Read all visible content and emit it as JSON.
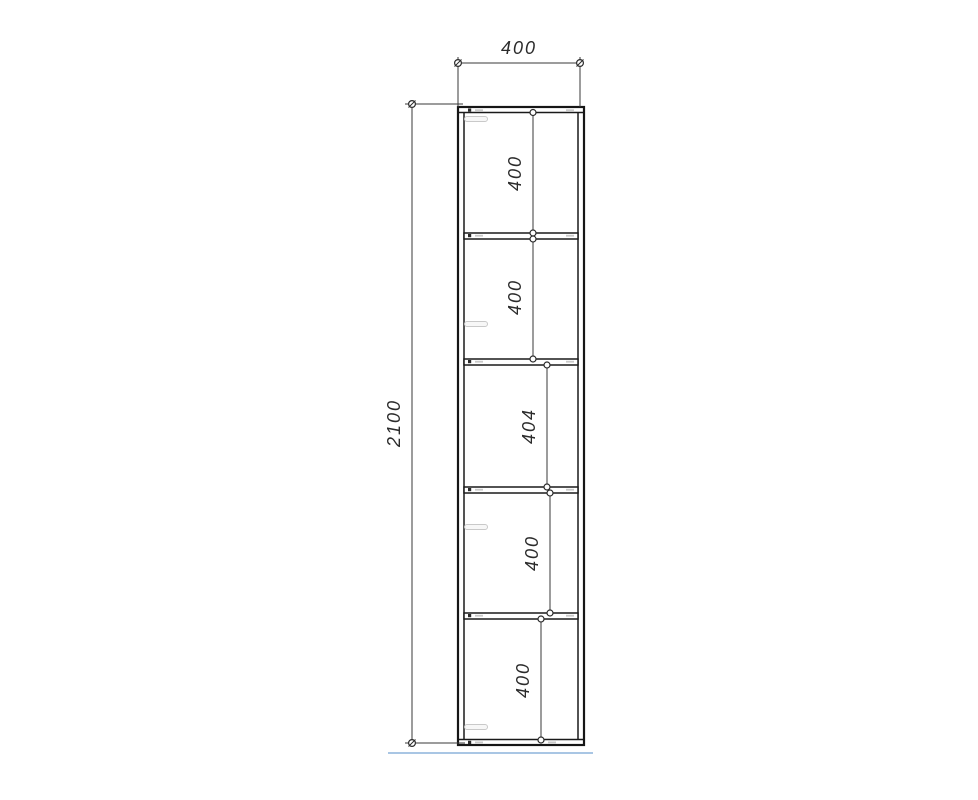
{
  "drawing": {
    "dimensions": {
      "width": "400",
      "height": "2100",
      "compartments": [
        "400",
        "400",
        "404",
        "400",
        "400"
      ]
    },
    "colors": {
      "background": "#ffffff",
      "outline": "#1a1a1a",
      "dimension_line": "#3a3a3a",
      "dimension_text": "#2b2b2b",
      "floor_line": "#a9c6e4",
      "hardware_mark": "#c9c9c9"
    }
  }
}
